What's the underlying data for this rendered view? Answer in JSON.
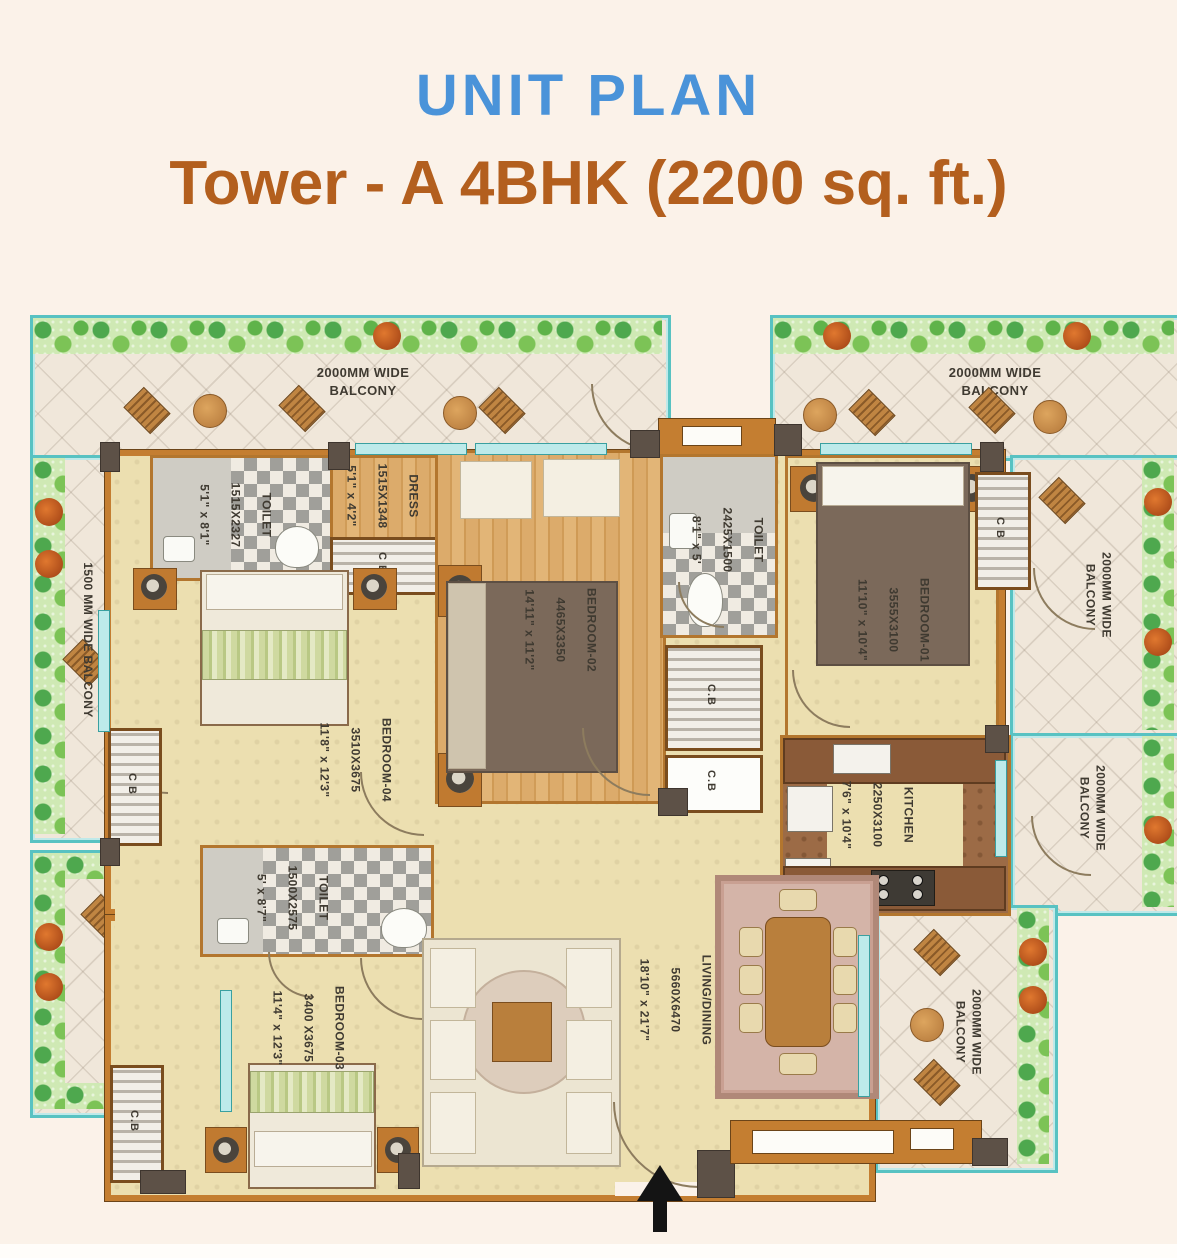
{
  "header": {
    "title": "UNIT PLAN",
    "subtitle": "Tower - A  4BHK (2200 sq. ft.)"
  },
  "balconies": {
    "top_left": "2000MM WIDE\nBALCONY",
    "top_right": "2000MM WIDE\nBALCONY",
    "left_upper": "1500 MM WIDE BALCONY",
    "left_lower": "1500 MM WIDE BALCONY",
    "right_upper": "2000MM WIDE\nBALCONY",
    "right_middle": "2000MM WIDE\nBALCONY",
    "bottom_right": "2000MM WIDE\nBALCONY"
  },
  "rooms": {
    "toilet1": {
      "name": "TOILET",
      "mm": "1515X2327",
      "ft": "5'1\" x 8'1\""
    },
    "dress": {
      "name": "DRESS",
      "mm": "1515X1348",
      "ft": "5'1\" x 4'2\""
    },
    "bedroom2": {
      "name": "BEDROOM-02",
      "mm": "4465X3350",
      "ft": "14'11\" x 11'2\""
    },
    "toilet_mid": {
      "name": "TOILET",
      "mm": "2425X1500",
      "ft": "8'1\" x 5'"
    },
    "bedroom1": {
      "name": "BEDROOM-01",
      "mm": "3555X3100",
      "ft": "11'10\" x 10'4\""
    },
    "kitchen": {
      "name": "KITCHEN",
      "mm": "2250X3100",
      "ft": "7'6\" x 10'4\""
    },
    "bedroom4": {
      "name": "BEDROOM-04",
      "mm": "3510X3675",
      "ft": "11'8\" x 12'3\""
    },
    "toilet2": {
      "name": "TOILET",
      "mm": "1500X2575",
      "ft": "5' x 8'7\""
    },
    "bedroom3": {
      "name": "BEDROOM-03",
      "mm": "3400 X3675",
      "ft": "11'4\" x 12'3\""
    },
    "living": {
      "name": "LIVING/DINING",
      "mm": "5660X6470",
      "ft": "18'10\" x 21'7\""
    }
  },
  "wardrobes": {
    "dress_cb": "C B",
    "passage_upper": "C.B",
    "passage_lower": "C.B",
    "bedroom1_cb": "C B",
    "bedroom4_cb": "C B",
    "bedroom3_cb": "C.B"
  },
  "icons": {
    "entrance_arrow": "up-arrow"
  },
  "colors": {
    "title_blue": "#4a93d9",
    "subtitle_orange": "#b35f1e",
    "wall_orange": "#c47e31",
    "wall_dark": "#5d5147",
    "floor_beige": "#ecdfb0",
    "wood_floor": "#d8a765",
    "glass_teal": "#58c2c2",
    "plant_green": "#7cc356",
    "checker_grey": "#a09f9a",
    "label_text": "#3f3a31",
    "page_background": "#fbf2e9"
  }
}
